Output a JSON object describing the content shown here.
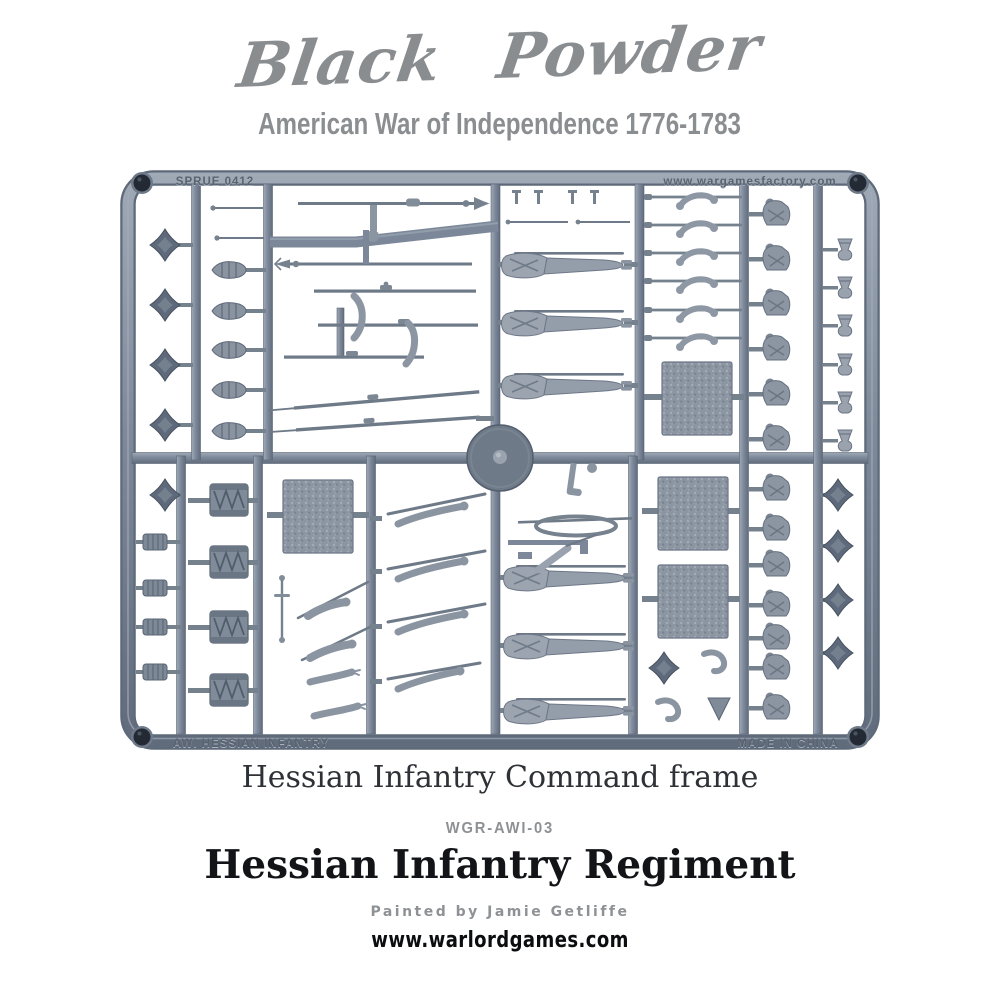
{
  "header": {
    "brand": "Black Powder",
    "subtitle": "American War of Independence 1776-1783"
  },
  "sprue": {
    "molded_text": {
      "top_left": "SPRUE 0412",
      "top_right": "www.wargamesfactory.com",
      "bottom_left": "AWI HESSIAN INFANTRY",
      "bottom_right": "MADE IN CHINA"
    },
    "plastic_color": "#7e8a9b",
    "parts": [
      "spear-point finials",
      "bayonet plumes",
      "muskets",
      "spontoons",
      "marching soldier figures",
      "command figures",
      "arms with muskets",
      "torsos",
      "mitre caps",
      "drums",
      "corded rolls",
      "textured square bases",
      "flag arms",
      "sword arms",
      "center hub",
      "corner eyelets"
    ]
  },
  "footer": {
    "frame_caption": "Hessian Infantry Command frame",
    "product_code": "WGR-AWI-03",
    "product_title": "Hessian Infantry Regiment",
    "credit": "Painted by Jamie Getliffe",
    "website": "www.warlordgames.com"
  },
  "colors": {
    "brand_gray": "#8a8d90",
    "muted_gray": "#8e9194",
    "text_black": "#131418",
    "plastic": "#7e8a9b",
    "plastic_dark": "#545f70",
    "plastic_light": "#aeb7c2"
  }
}
